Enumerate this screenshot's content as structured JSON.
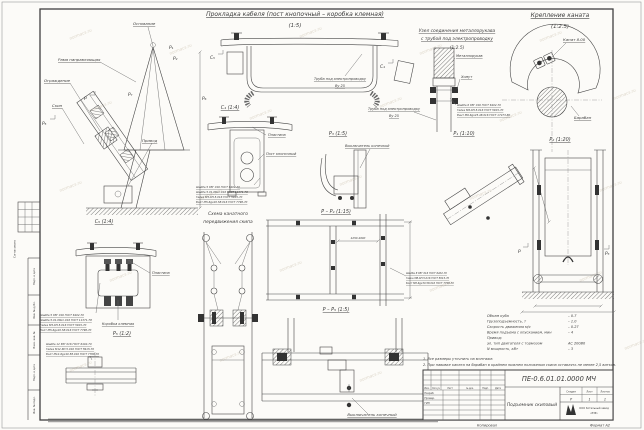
{
  "watermark": {
    "text": "normacs.ru"
  },
  "frame": {
    "kopiroval": "Копировал",
    "format": "Формат А2"
  },
  "left_strip": {
    "soglasovano": "Согласовано",
    "labels": [
      "Подп. и дата",
      "Инв. № дубл.",
      "Взам. инв. №",
      "Подп. и дата",
      "Инв. № подл."
    ]
  },
  "cable": {
    "title": "Прокладка кабеля (пост кнопочный – коробка клемная)",
    "scale": "(1:5)",
    "pipe_label": "Труба под электропроводку",
    "pipe_size": "Ву 25",
    "marker_c4": "С₄",
    "marker_c5": "С₅"
  },
  "hose": {
    "title1": "Узел соединения металлорукава",
    "title2": "с трубой под электропроводку",
    "scale": "(1:2.5)",
    "hose_label": "Металлорукав",
    "clamp_label": "Хомут",
    "pipe_label": "Труба под электропроводку",
    "pipe_size": "Ву 25",
    "specs": [
      "Шайба 6 65Г 016 ГОСТ 6402-70",
      "Гайка М6-6Н.5.016 ГОСТ 5915-70",
      "Винт М6-6gх25.48.016 ГОСТ 17473-80"
    ]
  },
  "rope": {
    "title": "Крепление каната",
    "scale": "(1:2.5)",
    "rope_label": "Канат 8.00",
    "drum_label": "Барабан"
  },
  "side": {
    "base": "Основание",
    "frame": "Рама направляющая",
    "guard": "Ограждение",
    "skip": "Скип",
    "drive": "Привод",
    "m_p1": "Р₁",
    "m_p2": "Р₂",
    "m_p5": "Р₅",
    "m_p6": "Р₆",
    "m_p7": "Р₇",
    "m_p": "Р"
  },
  "c4": {
    "title": "С₄ (1:4)",
    "plate": "Пластина",
    "post": "Пост кнопочный",
    "specs": [
      "Шайба 5 65Г 016 ГОСТ 6402-70",
      "Шайба 5.01.08кп.016 ГОСТ 11371-78",
      "Гайка М5-6Н.5.016 ГОСТ 5915-70",
      "Болт М5-6gх20.58.016 ГОСТ 7798-70"
    ]
  },
  "scheme": {
    "title1": "Схема канатного",
    "title2": "передвижения скипа"
  },
  "p3": {
    "title": "Р₃ (1:5)",
    "switch": "Выключатель конечный"
  },
  "p1": {
    "title": "Р₁ (1:10)"
  },
  "p2": {
    "title": "Р₂ (1:20)",
    "m_left": "Р",
    "m_right": "Р₃"
  },
  "c5": {
    "title": "С₅ (1:4)",
    "plate": "Пластина",
    "box": "Коробка клемная",
    "specs": [
      "Шайба 5 65Г 016 ГОСТ 6402-70",
      "Шайба 5.01.08кп.016 ГОСТ 11371-78",
      "Гайка М5-6Н.5.016 ГОСТ 5915-70",
      "Болт М5-6gх20.58.016 ГОСТ 7798-70"
    ]
  },
  "p5": {
    "title": "Р₅ (1:2)",
    "specs": [
      "Шайба 12 65Г 016 ГОСТ 6402-70",
      "Гайка М12-6Н.5.016 ГОСТ 5915-70",
      "Болт М12-6gх40.58.016 ГОСТ 7798-70"
    ]
  },
  "pp4": {
    "title": "Р – Р₄ (1:15)",
    "dim": "4250-4600",
    "specs": [
      "Шайба 8 65Г 016 ГОСТ 6402-70",
      "Гайка М8-6Н.5.016 ГОСТ 5915-70",
      "Болт М8-6gх30.58.016 ГОСТ 7798-70"
    ]
  },
  "pp5": {
    "title": "Р – Р₅ (1:5)",
    "switch": "Выключатель конечный"
  },
  "tech": {
    "rows": [
      {
        "label": "Объем куба",
        "value": "– 0.7"
      },
      {
        "label": "Грузоподъемность, т",
        "value": "– 1.0"
      },
      {
        "label": "Скорость движения м/с",
        "value": "– 0.27"
      },
      {
        "label": "Время подъема с опусканием, мин",
        "value": "– 4"
      },
      {
        "label": "Привод:",
        "value": ""
      },
      {
        "label": "эл. тип двигателя с тормозом",
        "value": "АС 200В0"
      },
      {
        "label": "N мощность, кВт",
        "value": "– 3"
      }
    ]
  },
  "notes": {
    "n1": "1. Все размеры уточнить на монтаже.",
    "n2": "2. При навивке каната на барабан в крайнем нижнем положении скипа оставлять не менее 2,5 витков."
  },
  "title_block": {
    "doc": "ПЕ-0.6.01.01.0000 МЧ",
    "name": "Подъемник скиповый",
    "stage_h": "Стадия",
    "sheet_h": "Лист",
    "sheets_h": "Листов",
    "stage": "Р",
    "sheet": "1",
    "sheets": "1",
    "company1": "ООО Котельный завод",
    "company2": "«РЗР»",
    "cols": [
      "Изм.",
      "Кол.уч",
      "Лист",
      "№ док.",
      "Подп.",
      "Дата"
    ],
    "roles": [
      "Разраб.",
      "Провер.",
      "ГИП"
    ]
  }
}
